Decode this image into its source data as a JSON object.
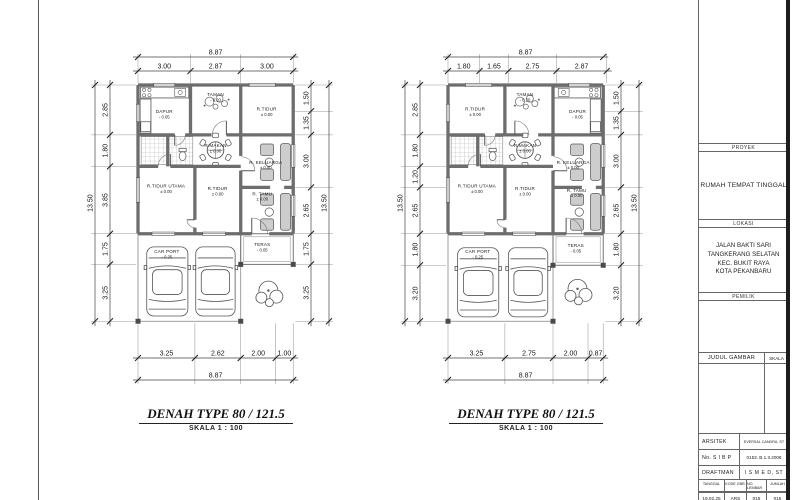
{
  "colors": {
    "ink": "#1a1a1a",
    "wall": "#6d6d6d",
    "paper": "#ffffff",
    "frame": "#5a5a5a"
  },
  "plans": [
    {
      "id": "left",
      "title": "DENAH TYPE 80 / 121.5",
      "scale_label": "SKALA 1 : 100",
      "dims": {
        "top": [
          "3.00",
          "2.87",
          "3.00"
        ],
        "top_total": "8.87",
        "bottom": [
          "3.25",
          "2.62",
          "2.00",
          "1.00"
        ],
        "bottom_total": "8.87",
        "left": [
          "2.85",
          "1.80",
          "3.85",
          "1.75",
          "3.25"
        ],
        "left_total": "13.50",
        "right": [
          "1.50",
          "1.35",
          "3.00",
          "2.65",
          "1.75",
          "3.25"
        ],
        "right_total": "13.50"
      },
      "rooms": [
        {
          "name": "DAPUR",
          "elev": "- 0.05",
          "x": 1.5,
          "y": 1.6
        },
        {
          "name": "TAMAN",
          "elev": "- 0.20",
          "x": 4.43,
          "y": 0.62
        },
        {
          "name": "R.TIDUR",
          "elev": "± 0.00",
          "x": 7.35,
          "y": 1.45
        },
        {
          "name": "R.MAKAN",
          "elev": "± 0.00",
          "x": 4.43,
          "y": 3.55
        },
        {
          "name": "R. KELUARGA",
          "elev": "± 0.00",
          "x": 7.3,
          "y": 4.5
        },
        {
          "name": "R.TIDUR UTAMA",
          "elev": "± 0.00",
          "x": 1.6,
          "y": 5.85
        },
        {
          "name": "R.TIDUR",
          "elev": "± 0.00",
          "x": 4.55,
          "y": 6.0
        },
        {
          "name": "R. TAMU",
          "elev": "± 0.00",
          "x": 7.1,
          "y": 6.3
        },
        {
          "name": "TERAS",
          "elev": "- 0.05",
          "x": 7.1,
          "y": 9.2
        },
        {
          "name": "CAR PORT",
          "elev": "- 0.25",
          "x": 1.65,
          "y": 9.6
        }
      ]
    },
    {
      "id": "right",
      "title": "DENAH TYPE 80 / 121.5",
      "scale_label": "SKALA 1 : 100",
      "dims": {
        "top": [
          "1.80",
          "1.65",
          "2.75",
          "2.87"
        ],
        "top_total": "8.87",
        "bottom": [
          "3.25",
          "2.75",
          "2.00",
          "0.87"
        ],
        "bottom_total": "8.87",
        "left": [
          "2.85",
          "1.80",
          "1.20",
          "2.65",
          "1.80",
          "3.20"
        ],
        "left_total": "13.50",
        "right": [
          "1.50",
          "1.35",
          "3.00",
          "2.65",
          "1.80",
          "3.20"
        ],
        "right_total": "13.50"
      },
      "rooms": [
        {
          "name": "R.TIDUR",
          "elev": "± 0.00",
          "x": 1.55,
          "y": 1.45
        },
        {
          "name": "TAMAN",
          "elev": "- 0.20",
          "x": 4.4,
          "y": 0.62
        },
        {
          "name": "DAPUR",
          "elev": "- 0.05",
          "x": 7.4,
          "y": 1.6
        },
        {
          "name": "R.MAKAN",
          "elev": "± 0.00",
          "x": 4.4,
          "y": 3.55
        },
        {
          "name": "R. KELUARGA",
          "elev": "± 0.00",
          "x": 7.15,
          "y": 4.5
        },
        {
          "name": "R.TIDUR UTAMA",
          "elev": "± 0.00",
          "x": 1.65,
          "y": 5.85
        },
        {
          "name": "R.TIDUR",
          "elev": "± 0.00",
          "x": 4.4,
          "y": 6.0
        },
        {
          "name": "R. TAMU",
          "elev": "± 0.00",
          "x": 7.35,
          "y": 6.1
        },
        {
          "name": "TERAS",
          "elev": "- 0.05",
          "x": 7.3,
          "y": 9.25
        },
        {
          "name": "CAR PORT",
          "elev": "- 0.25",
          "x": 1.7,
          "y": 9.6
        }
      ]
    }
  ],
  "title_block": {
    "proyek_label": "PROYEK",
    "proyek": "RUMAH TEMPAT TINGGAL",
    "lokasi_label": "LOKASI",
    "lokasi_lines": [
      "JALAN BAKTI SARI",
      "TANGKERANG SELATAN",
      "KEC. BUKIT RAYA",
      "KOTA PEKANBARU"
    ],
    "pemilik_label": "PEMILIK",
    "judul_gambar_label": "JUDUL GAMBAR",
    "skala_label": "SKALA",
    "arsitek_label": "ARSITEK",
    "arsitek": "EVERSAL CANDRA, ST",
    "sibp_label": "No. S I B P",
    "sibp": "0153. B.1.II.2008",
    "draftman_label": "DRAFTMAN",
    "draftman": "I S M E D, ST",
    "footer_headers": [
      "TANGGAL",
      "KODE GBR.",
      "NO. LEMBAR",
      "JUMLAH"
    ],
    "footer_values": [
      "19.02.25",
      "ARS",
      "015",
      "015"
    ]
  }
}
